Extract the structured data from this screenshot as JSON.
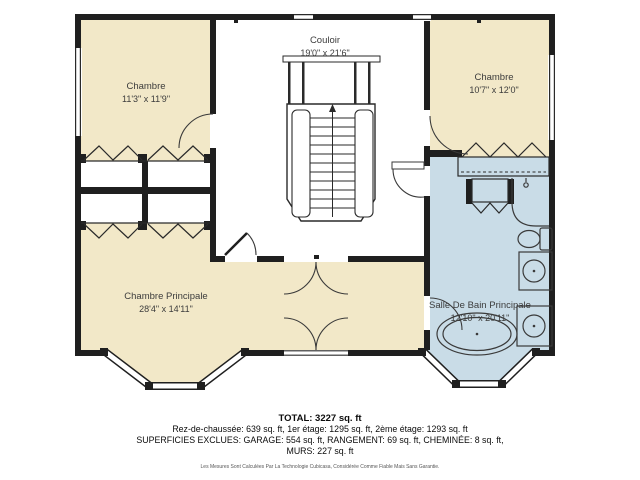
{
  "plan": {
    "rooms": [
      {
        "name": "couloir",
        "label": "Couloir",
        "dims": "19'0\" x 21'6\""
      },
      {
        "name": "chambre-top-left",
        "label": "Chambre",
        "dims": "11'3\" x 11'9\""
      },
      {
        "name": "chambre-top-right",
        "label": "Chambre",
        "dims": "10'7\" x 12'0\""
      },
      {
        "name": "chambre-principale",
        "label": "Chambre Principale",
        "dims": "28'4\" x 14'11\""
      },
      {
        "name": "salle-de-bain-principale",
        "label": "Salle De Bain Principale",
        "dims": "12'10\" x 20'11\""
      }
    ],
    "colors": {
      "bedroom_fill": "#f2e8c8",
      "bathroom_fill": "#c9dce7",
      "wall": "#1f1f1f"
    }
  },
  "summary": {
    "total": "TOTAL: 3227 sq. ft",
    "line1": "Rez-de-chaussée: 639 sq. ft, 1er étage: 1295 sq. ft, 2ème étage: 1293 sq. ft",
    "line2": "SUPERFICIES EXCLUES: GARAGE: 554 sq. ft, RANGEMENT: 69 sq. ft, CHEMINÉE: 8 sq. ft,",
    "line3": "MURS: 227 sq. ft",
    "disclaimer": "Les Mesures Sont Calculées Par La Technologie Cubicasa, Considérée Comme Fiable Mais Sans Garantie."
  }
}
